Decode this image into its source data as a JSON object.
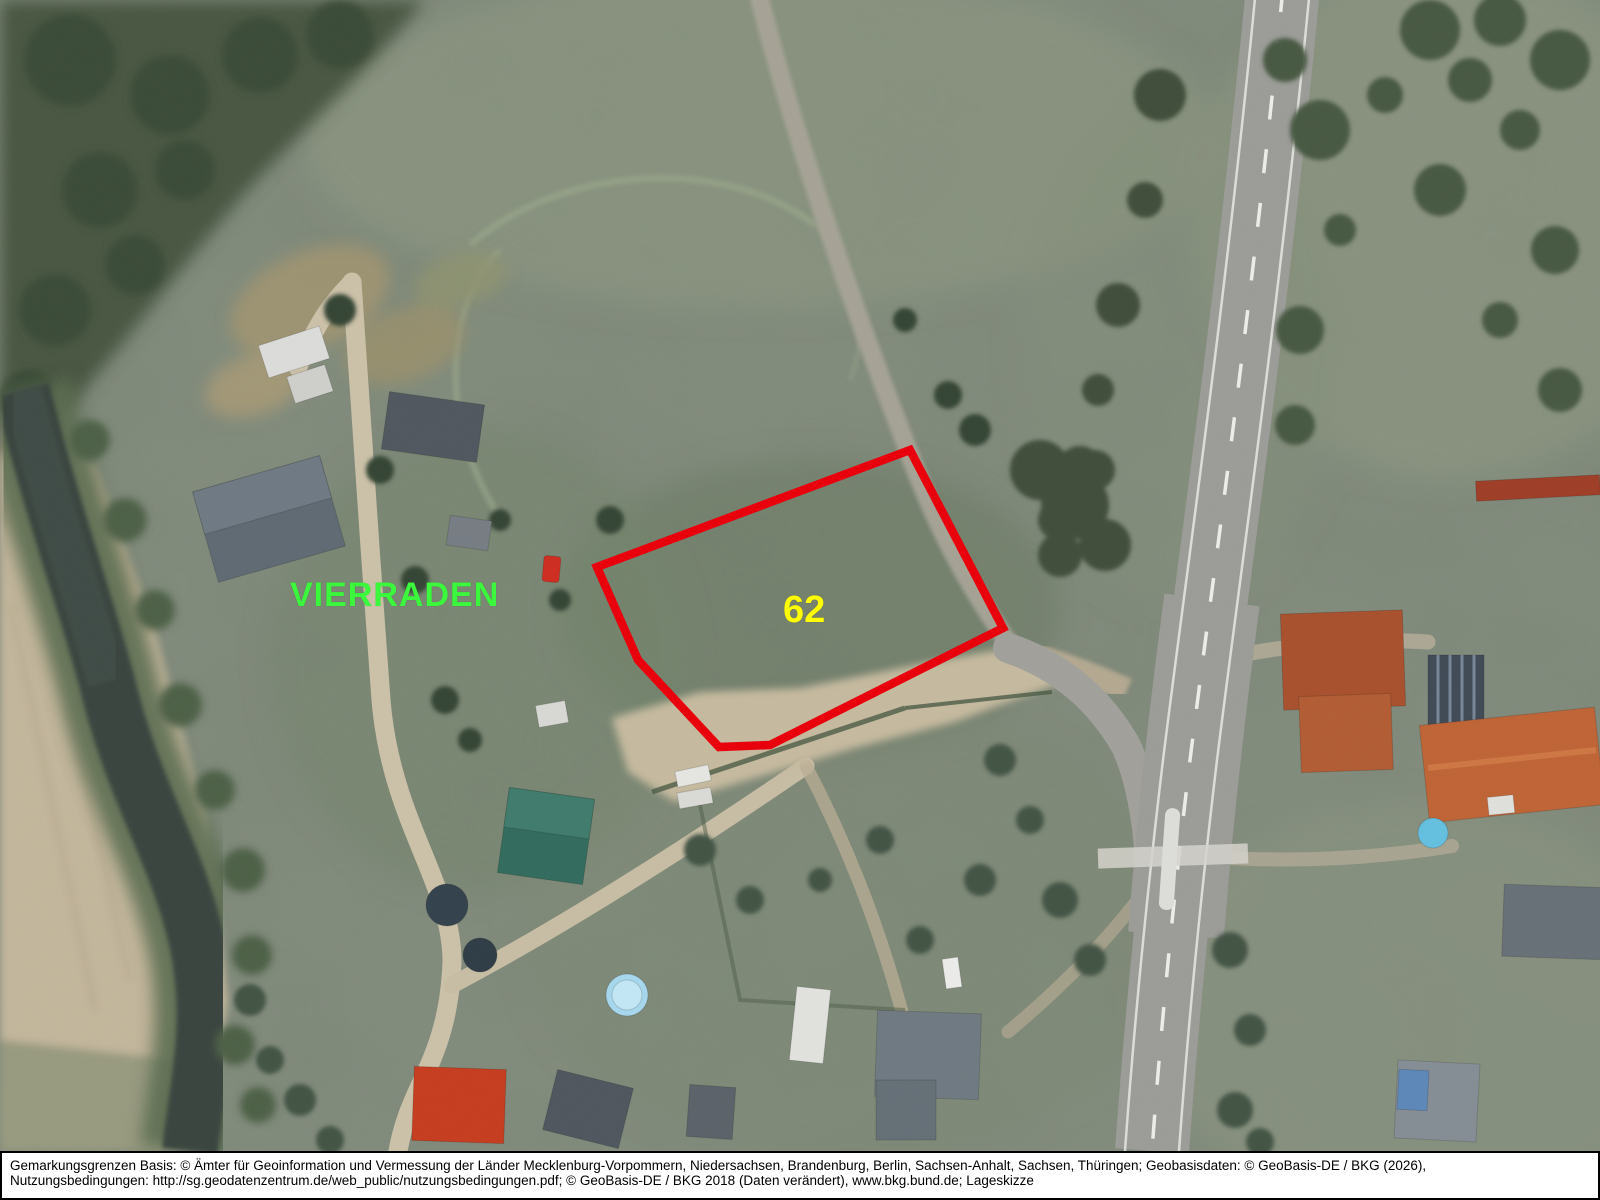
{
  "map": {
    "place_label": "VIERRADEN",
    "place_label_color": "#3cf83c",
    "parcel_label": "62",
    "parcel_label_color": "#ffff00",
    "parcel_outline_color": "#e8000d",
    "parcel_polygon_points": "597,567 910,450 1003,628 770,745 719,747 638,660"
  },
  "footer": {
    "line1": "Gemarkungsgrenzen Basis: © Ämter für Geoinformation und Vermessung der Länder Mecklenburg-Vorpommern, Niedersachsen, Brandenburg, Berlin, Sachsen-Anhalt, Sachsen, Thüringen; Geobasisdaten: © GeoBasis-DE / BKG (2026),",
    "line2": "Nutzungsbedingungen: http://sg.geodatenzentrum.de/web_public/nutzungsbedingungen.pdf; © GeoBasis-DE / BKG 2018 (Daten verändert), www.bkg.bund.de; Lageskizze"
  }
}
